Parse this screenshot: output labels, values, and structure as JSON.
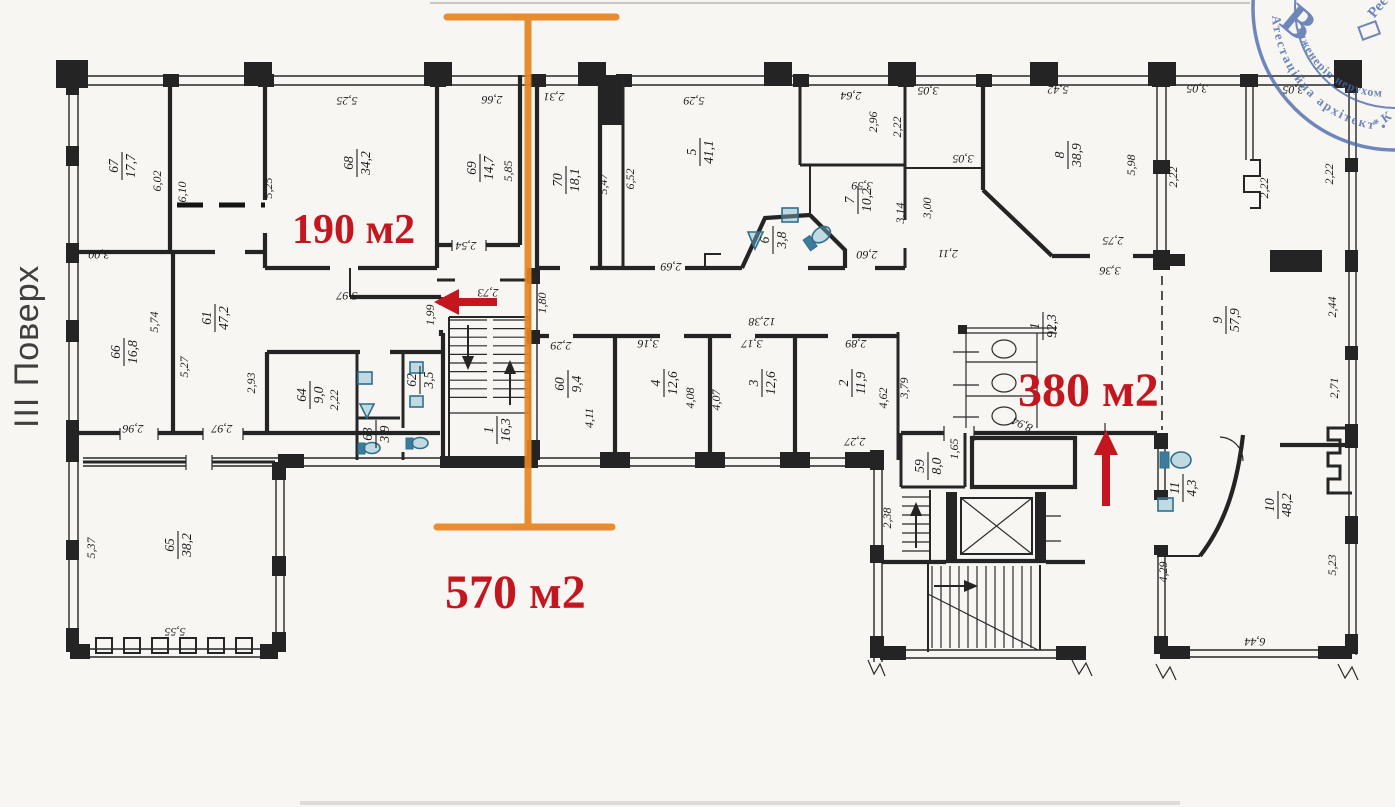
{
  "annotations": {
    "floor_label": "III Поверх",
    "zone_small": {
      "text": "190 м2"
    },
    "zone_left": {
      "text": "570 м2"
    },
    "zone_right": {
      "text": "380 м2"
    },
    "colors": {
      "red": "#c3161f",
      "orange": "#e8831f",
      "stamp_blue": "#4a67ac",
      "wall": "#242424",
      "fixture_blue": "#3d7d9b"
    }
  },
  "stamp": {
    "ring_outer": "Атестаційна архітект • Асоціація Укр • ального гос",
    "ring_inner": "Інженерів нерухом",
    "monogram": "В",
    "side_fragment": "Реє",
    "corner_fragment": "* К"
  },
  "rooms": [
    {
      "num": "67",
      "area": "17,7",
      "x": 122,
      "y": 166
    },
    {
      "num": "68",
      "area": "34,2",
      "x": 357,
      "y": 163
    },
    {
      "num": "69",
      "area": "14,7",
      "x": 480,
      "y": 168
    },
    {
      "num": "70",
      "area": "18,1",
      "x": 566,
      "y": 180
    },
    {
      "num": "5",
      "area": "41,1",
      "x": 700,
      "y": 152
    },
    {
      "num": "6",
      "area": "3,8",
      "x": 773,
      "y": 240
    },
    {
      "num": "7",
      "area": "10,2",
      "x": 858,
      "y": 200
    },
    {
      "num": "8",
      "area": "38,9",
      "x": 1068,
      "y": 155
    },
    {
      "num": "9",
      "area": "57,9",
      "x": 1226,
      "y": 320
    },
    {
      "num": "66",
      "area": "16,8",
      "x": 124,
      "y": 352
    },
    {
      "num": "61",
      "area": "47,2",
      "x": 215,
      "y": 318
    },
    {
      "num": "64",
      "area": "9,0",
      "x": 310,
      "y": 395
    },
    {
      "num": "63",
      "area": "3,9",
      "x": 376,
      "y": 434
    },
    {
      "num": "62",
      "area": "3,5",
      "x": 420,
      "y": 380
    },
    {
      "num": "1",
      "area": "16,3",
      "x": 497,
      "y": 430
    },
    {
      "num": "60",
      "area": "9,4",
      "x": 568,
      "y": 384
    },
    {
      "num": "4",
      "area": "12,6",
      "x": 664,
      "y": 383
    },
    {
      "num": "3",
      "area": "12,6",
      "x": 762,
      "y": 383
    },
    {
      "num": "2",
      "area": "11,9",
      "x": 852,
      "y": 383
    },
    {
      "num": "59",
      "area": "8,0",
      "x": 928,
      "y": 466
    },
    {
      "num": "1",
      "area": "92,3",
      "x": 1043,
      "y": 326
    },
    {
      "num": "11",
      "area": "4,3",
      "x": 1183,
      "y": 488
    },
    {
      "num": "10",
      "area": "48,2",
      "x": 1278,
      "y": 505
    },
    {
      "num": "65",
      "area": "38,2",
      "x": 178,
      "y": 545
    }
  ],
  "dims": [
    {
      "t": "2,66",
      "x": 492,
      "y": 96,
      "r": 180
    },
    {
      "t": "5,25",
      "x": 347,
      "y": 97,
      "r": 180
    },
    {
      "t": "5,25",
      "x": 272,
      "y": 188,
      "r": -90
    },
    {
      "t": "6,02",
      "x": 161,
      "y": 181,
      "r": -90
    },
    {
      "t": "6,10",
      "x": 186,
      "y": 192,
      "r": -90
    },
    {
      "t": "3,00",
      "x": 99,
      "y": 251,
      "r": 180
    },
    {
      "t": "2,31",
      "x": 554,
      "y": 93,
      "r": 180
    },
    {
      "t": "5,85",
      "x": 512,
      "y": 171,
      "r": -90
    },
    {
      "t": "2,54",
      "x": 466,
      "y": 242,
      "r": 180
    },
    {
      "t": "5,97",
      "x": 347,
      "y": 292,
      "r": 180
    },
    {
      "t": "2,73",
      "x": 488,
      "y": 289,
      "r": 180
    },
    {
      "t": "1,99",
      "x": 434,
      "y": 315,
      "r": -90
    },
    {
      "t": "5,47",
      "x": 607,
      "y": 184,
      "r": -90
    },
    {
      "t": "6,52",
      "x": 634,
      "y": 179,
      "r": -90
    },
    {
      "t": "5,29",
      "x": 694,
      "y": 97,
      "r": 180
    },
    {
      "t": "2,69",
      "x": 671,
      "y": 263,
      "r": 180
    },
    {
      "t": "1,80",
      "x": 546,
      "y": 303,
      "r": -90
    },
    {
      "t": "2,64",
      "x": 851,
      "y": 92,
      "r": 180
    },
    {
      "t": "2,96",
      "x": 877,
      "y": 122,
      "r": -90
    },
    {
      "t": "2,22",
      "x": 901,
      "y": 127,
      "r": -90
    },
    {
      "t": "3,05",
      "x": 928,
      "y": 87,
      "r": 180
    },
    {
      "t": "3,05",
      "x": 963,
      "y": 155,
      "r": 180
    },
    {
      "t": "3,59",
      "x": 862,
      "y": 182,
      "r": 180
    },
    {
      "t": "3,14",
      "x": 904,
      "y": 213,
      "r": -90
    },
    {
      "t": "3,00",
      "x": 931,
      "y": 208,
      "r": -90
    },
    {
      "t": "2,60",
      "x": 867,
      "y": 251,
      "r": 180
    },
    {
      "t": "2,11",
      "x": 948,
      "y": 250,
      "r": 180
    },
    {
      "t": "5,42",
      "x": 1058,
      "y": 86,
      "r": 180
    },
    {
      "t": "5,98",
      "x": 1135,
      "y": 165,
      "r": -90
    },
    {
      "t": "3,05",
      "x": 1197,
      "y": 85,
      "r": 180
    },
    {
      "t": "3,05",
      "x": 1293,
      "y": 86,
      "r": 180
    },
    {
      "t": "2,22",
      "x": 1177,
      "y": 177,
      "r": -90
    },
    {
      "t": "2,22",
      "x": 1268,
      "y": 188,
      "r": -90
    },
    {
      "t": "2,22",
      "x": 1333,
      "y": 174,
      "r": -90
    },
    {
      "t": "2,75",
      "x": 1113,
      "y": 237,
      "r": 180
    },
    {
      "t": "3,36",
      "x": 1110,
      "y": 267,
      "r": 180
    },
    {
      "t": "2,44",
      "x": 1336,
      "y": 307,
      "r": -90
    },
    {
      "t": "2,71",
      "x": 1338,
      "y": 388,
      "r": -90
    },
    {
      "t": "12,38",
      "x": 762,
      "y": 318,
      "r": 180
    },
    {
      "t": "2,29",
      "x": 561,
      "y": 342,
      "r": 180
    },
    {
      "t": "3,16",
      "x": 648,
      "y": 340,
      "r": 180
    },
    {
      "t": "3,17",
      "x": 752,
      "y": 340,
      "r": 180
    },
    {
      "t": "2,89",
      "x": 856,
      "y": 340,
      "r": 180
    },
    {
      "t": "4,11",
      "x": 593,
      "y": 418,
      "r": -90
    },
    {
      "t": "2,22",
      "x": 338,
      "y": 400,
      "r": -90
    },
    {
      "t": "4,08",
      "x": 694,
      "y": 398,
      "r": -90
    },
    {
      "t": "4,07",
      "x": 720,
      "y": 400,
      "r": -90
    },
    {
      "t": "4,62",
      "x": 887,
      "y": 398,
      "r": -90
    },
    {
      "t": "3,79",
      "x": 908,
      "y": 388,
      "r": -90
    },
    {
      "t": "2,27",
      "x": 855,
      "y": 438,
      "r": 180
    },
    {
      "t": "1,65",
      "x": 958,
      "y": 449,
      "r": -90
    },
    {
      "t": "2,38",
      "x": 891,
      "y": 518,
      "r": -90
    },
    {
      "t": "8,94",
      "x": 1024,
      "y": 421,
      "r": 205
    },
    {
      "t": "4,29",
      "x": 1167,
      "y": 572,
      "r": -90
    },
    {
      "t": "6,44",
      "x": 1255,
      "y": 638,
      "r": 180
    },
    {
      "t": "5,23",
      "x": 1336,
      "y": 565,
      "r": -90
    },
    {
      "t": "5,74",
      "x": 158,
      "y": 322,
      "r": -90
    },
    {
      "t": "5,27",
      "x": 188,
      "y": 367,
      "r": -90
    },
    {
      "t": "2,93",
      "x": 255,
      "y": 383,
      "r": -90
    },
    {
      "t": "2,96",
      "x": 133,
      "y": 425,
      "r": 180
    },
    {
      "t": "2,97",
      "x": 222,
      "y": 425,
      "r": 180
    },
    {
      "t": "5,37",
      "x": 95,
      "y": 548,
      "r": -90
    },
    {
      "t": "5,55",
      "x": 175,
      "y": 628,
      "r": 180
    }
  ]
}
